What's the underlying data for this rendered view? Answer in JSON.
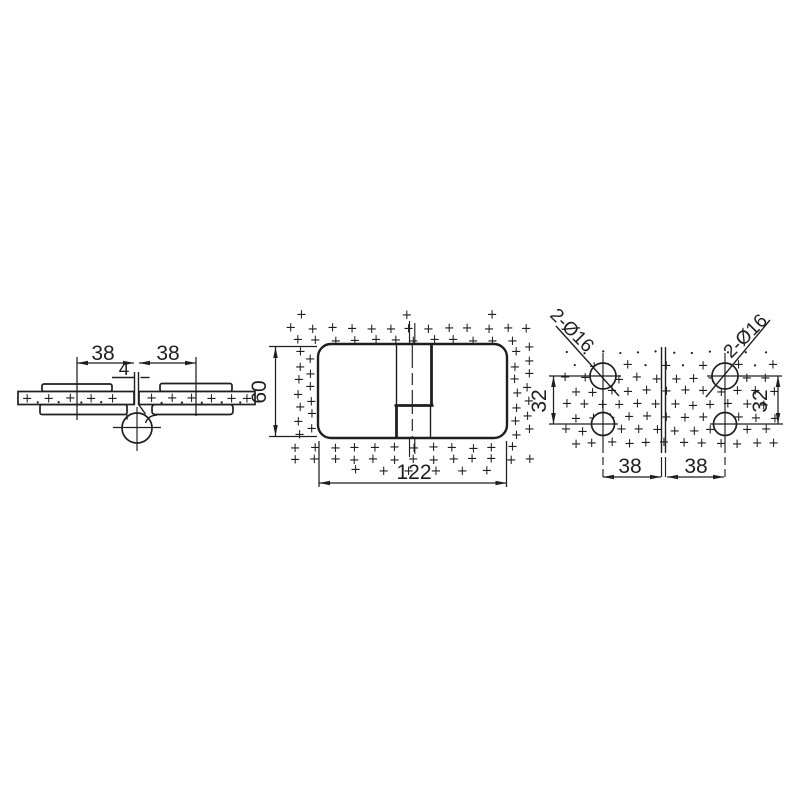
{
  "colors": {
    "ink": "#1f1f1f",
    "paper": "#ffffff"
  },
  "drawing": {
    "texture_symbol": "+",
    "side_view": {
      "dim_left": "38",
      "dim_right": "38",
      "dim_gap": "4"
    },
    "front_view": {
      "dim_height": "60",
      "dim_width": "122"
    },
    "hole_view": {
      "left": {
        "holes_label": "2-Ø16",
        "dim_spacing": "32",
        "dim_edge": "38"
      },
      "right": {
        "holes_label": "2-Ø16",
        "dim_spacing": "32",
        "dim_edge": "38"
      }
    }
  }
}
